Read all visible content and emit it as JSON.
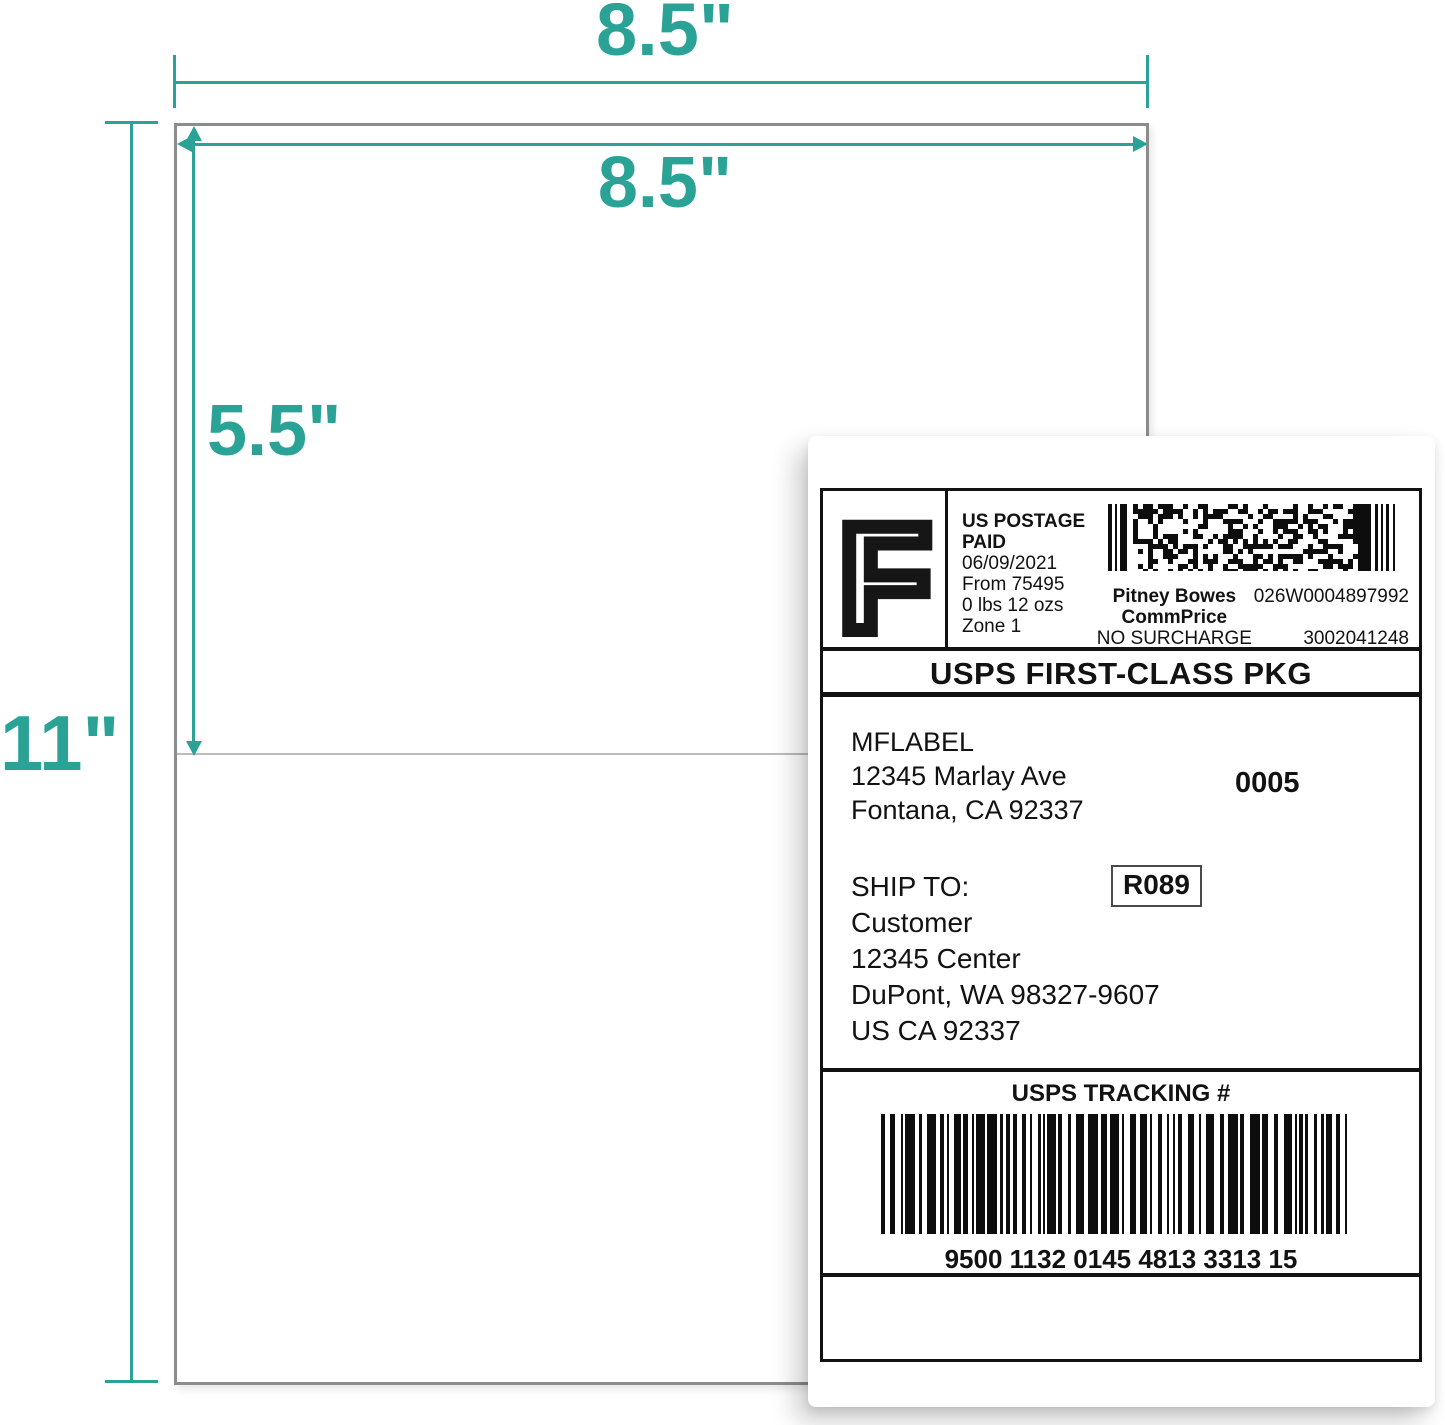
{
  "colors": {
    "accent_teal": "#2aa396",
    "paper_border_gray": "#8c8c8c",
    "perforation_gray": "#bcbcbc",
    "label_black": "#121212"
  },
  "dimensions": {
    "sheet_width": "8.5\"",
    "sheet_height": "11\"",
    "label_width": "8.5\"",
    "label_height": "5.5\""
  },
  "shipping_label": {
    "postage": {
      "indicia_letter": "F",
      "postage_line1": "US POSTAGE",
      "postage_line2": "PAID",
      "date": "06/09/2021",
      "origin": "From 75495",
      "weight": "0 lbs 12 ozs",
      "zone": "Zone 1",
      "carrier": "Pitney Bowes",
      "rate_type": "CommPrice",
      "surcharge": "NO SURCHARGE",
      "meter_id": "026W0004897992",
      "account_id": "3002041248"
    },
    "service": "USPS FIRST-CLASS PKG",
    "sender": {
      "name": "MFLABEL",
      "address_line": "12345 Marlay Ave",
      "city_line": "Fontana, CA 92337",
      "sequence_number": "0005"
    },
    "recipient": {
      "label": "SHIP TO:",
      "name": "Customer",
      "address_line": "12345 Center",
      "city_line": "DuPont, WA 98327-9607",
      "country_line": "US CA 92337",
      "route_code": "R089"
    },
    "tracking": {
      "header": "USPS TRACKING #",
      "number": "9500 1132 0145 4813 3313 15"
    }
  }
}
